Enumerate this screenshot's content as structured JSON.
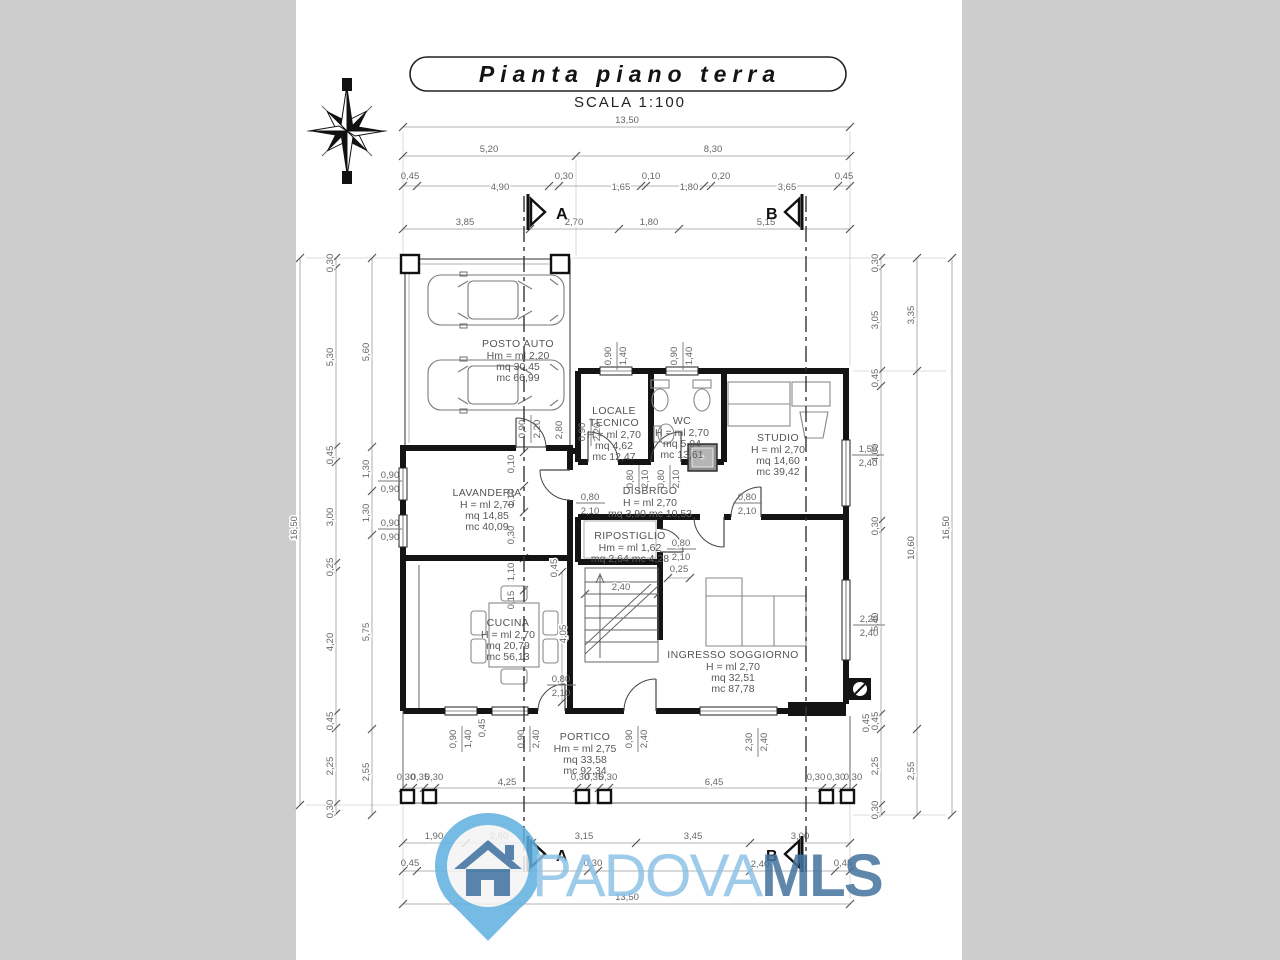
{
  "header": {
    "title": "Pianta piano terra",
    "scale": "SCALA  1:100"
  },
  "sections": {
    "a": "A",
    "b": "B"
  },
  "watermark": {
    "name": "PADOVA",
    "suffix": "MLS"
  },
  "rooms": {
    "posto_auto": {
      "name": "POSTO AUTO",
      "stats": [
        "Hm = ml 2,20",
        "mq 30,45",
        "mc 66,99"
      ]
    },
    "locale_tecnico": {
      "name1": "LOCALE",
      "name2": "TECNICO",
      "stats": [
        "H = ml 2,70",
        "mq 4,62",
        "mc 12,47"
      ]
    },
    "wc": {
      "name": "WC",
      "stats": [
        "H = ml 2,70",
        "mq 5,04",
        "mc 13,61"
      ]
    },
    "studio": {
      "name": "STUDIO",
      "stats": [
        "H = ml 2,70",
        "mq 14,60",
        "mc 39,42"
      ]
    },
    "lavanderia": {
      "name": "LAVANDERIA",
      "stats": [
        "H = ml 2,70",
        "mq 14,85",
        "mc 40,09"
      ]
    },
    "disbrigo": {
      "name": "DISBRIGO",
      "stats": [
        "H = ml 2,70",
        "mq 3,90   mc 10,53"
      ]
    },
    "ripostiglio": {
      "name": "RIPOSTIGLIO",
      "stats": [
        "Hm = ml 1,62",
        "mq 2,64   mc 4,28"
      ]
    },
    "cucina": {
      "name": "CUCINA",
      "stats": [
        "H = ml 2,70",
        "mq 20,79",
        "mc 56,13"
      ]
    },
    "ingresso": {
      "name": "INGRESSO SOGGIORNO",
      "stats": [
        "H = ml 2,70",
        "mq 32,51",
        "mc 87,78"
      ]
    },
    "portico": {
      "name": "PORTICO",
      "stats": [
        "Hm = ml 2,75",
        "mq 33,58",
        "mc 92,34"
      ]
    }
  },
  "dims": {
    "top1": [
      "13,50"
    ],
    "top2": [
      "5,20",
      "8,30"
    ],
    "top3": [
      "0,45",
      "4,90",
      "0,30",
      "1,65",
      "0,10",
      "1,80",
      "0,20",
      "3,65",
      "0,45"
    ],
    "top4": [
      "3,85",
      "2,70",
      "1,80",
      "5,15"
    ],
    "bottom_pillars": [
      "0,30",
      "0,35",
      "0,30",
      "4,25",
      "0,30",
      "0,35",
      "0,30",
      "6,45",
      "0,30",
      "0,30",
      "0,30"
    ],
    "bottom1": [
      "1,90",
      "2,60",
      "3,15",
      "3,45",
      "3,00"
    ],
    "bottom2": [
      "0,45",
      "0,30",
      "2,40",
      "0,45"
    ],
    "bottom3": [
      "13,50"
    ],
    "left_outer": "16,50",
    "left_mid": [
      "0,30",
      "5,30",
      "0,45",
      "3,00",
      "0,25",
      "4,20",
      "0,45",
      "2,25",
      "0,30"
    ],
    "left_inner": [
      "5,60",
      "1,30",
      "1,30",
      "5,75",
      "2,55"
    ],
    "right_inner": [
      "0,30",
      "3,05",
      "0,45",
      "4,00",
      "0,30",
      "5,40",
      "0,45",
      "2,25",
      "0,30"
    ],
    "right_mid": [
      "3,35",
      "10,60",
      "2,55"
    ],
    "right_outer": "16,50"
  },
  "openings": {
    "win_left_1": [
      "0,90",
      "0,90"
    ],
    "win_left_2": [
      "0,90",
      "0,90"
    ],
    "win_top_1": [
      "0,90",
      "1,40"
    ],
    "win_top_2": [
      "0,90",
      "1,40"
    ],
    "win_right_studio": [
      "1,50",
      "2,40"
    ],
    "win_right_sogg": [
      "2,20",
      "2,40"
    ],
    "win_s1": [
      "0,90",
      "1,40"
    ],
    "win_s2": [
      "0,90",
      "2,40"
    ],
    "win_s3": [
      "0,90",
      "2,40"
    ],
    "door_s": [
      "2,30",
      "2,40"
    ],
    "door_lav": [
      "0,80",
      "2,10"
    ],
    "door_studio": [
      "0,80",
      "2,10"
    ],
    "door_rip": [
      "0,80",
      "2,10"
    ],
    "door_wc": [
      "0,80",
      "2,10"
    ],
    "door_loc": [
      "0,80",
      "2,10"
    ],
    "door_cucina": [
      "0,80",
      "2,10"
    ],
    "door_garage": [
      "0,90",
      "2,20"
    ],
    "door_garage2": [
      "0,90",
      "2,20"
    ]
  },
  "misc": {
    "a_col": [
      "0,10",
      "1,10",
      "0,30",
      "1,10",
      "0,15"
    ],
    "stair_w": "2,40",
    "stair_gap": "0,25",
    "cucina_h": "4,05",
    "wall_a": "0,45",
    "wall_b": "0,45",
    "wall_c": "0,45",
    "garage_wall": "2,80"
  },
  "colors": {
    "wall": "#141414",
    "dim_text": "#666666",
    "watermark_light": "#8cc2e6",
    "watermark_dark": "#44739e",
    "pin_blue": "#5fb0e0"
  }
}
